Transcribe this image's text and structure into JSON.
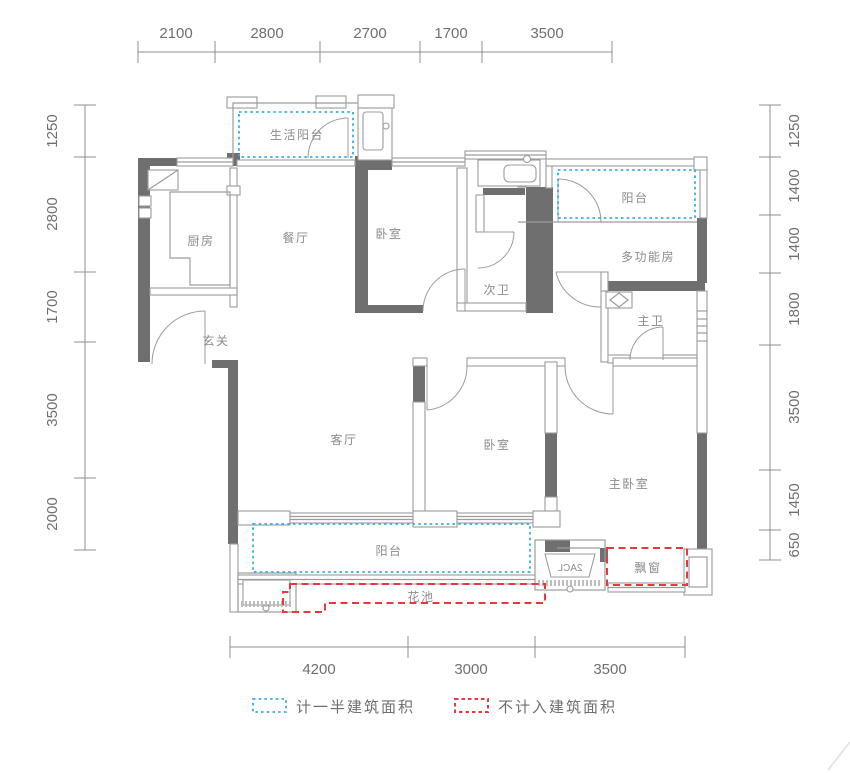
{
  "rooms": [
    {
      "id": "life-balcony",
      "label": "生活阳台"
    },
    {
      "id": "kitchen",
      "label": "厨房"
    },
    {
      "id": "dining",
      "label": "餐厅"
    },
    {
      "id": "bedroom-top",
      "label": "卧室"
    },
    {
      "id": "bath-second",
      "label": "次卫"
    },
    {
      "id": "balcony-top",
      "label": "阳台"
    },
    {
      "id": "multi-function",
      "label": "多功能房"
    },
    {
      "id": "bath-master",
      "label": "主卫"
    },
    {
      "id": "entry",
      "label": "玄关"
    },
    {
      "id": "living",
      "label": "客厅"
    },
    {
      "id": "bedroom-bottom",
      "label": "卧室"
    },
    {
      "id": "master-bedroom",
      "label": "主卧室"
    },
    {
      "id": "balcony-bottom",
      "label": "阳台"
    },
    {
      "id": "flower-bed",
      "label": "花池"
    },
    {
      "id": "bay-window",
      "label": "飘窗"
    }
  ],
  "fixture_text": "2ACL",
  "dimensions": {
    "top": [
      "2100",
      "2800",
      "2700",
      "1700",
      "3500"
    ],
    "bottom": [
      "4200",
      "3000",
      "3500"
    ],
    "left": [
      "1250",
      "2800",
      "1700",
      "3500",
      "2000"
    ],
    "right": [
      "1250",
      "1400",
      "1400",
      "1800",
      "3500",
      "1450",
      "650"
    ]
  },
  "legend": [
    {
      "style": "blue-dotted",
      "label": "计一半建筑面积"
    },
    {
      "style": "red-dashed",
      "label": "不计入建筑面积"
    }
  ],
  "colors": {
    "wall": "#6f6f6f",
    "thin_line": "#9c9c9c",
    "room_text": "#8c8c8c",
    "dim_text": "#6f6f6f",
    "half_area_blue": "#35aee2",
    "excluded_red": "#e8383d"
  }
}
